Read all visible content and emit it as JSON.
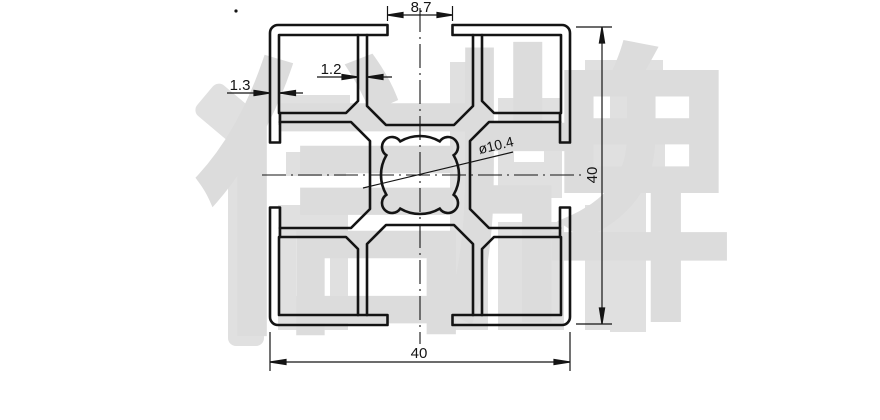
{
  "dimensions": {
    "slot_width": {
      "label": "8.7"
    },
    "inner_wall": {
      "label": "1.2"
    },
    "outer_wall": {
      "label": "1.3"
    },
    "bore": {
      "label": "ø10.4"
    },
    "overall_width": {
      "label": "40"
    },
    "overall_height": {
      "label": "40"
    }
  },
  "watermark": {
    "text": "信牌",
    "char1": "信",
    "char2": "牌",
    "color": "#dcdcdc"
  },
  "colors": {
    "line": "#141414",
    "background": "#ffffff",
    "watermark": "#dcdcdc"
  }
}
